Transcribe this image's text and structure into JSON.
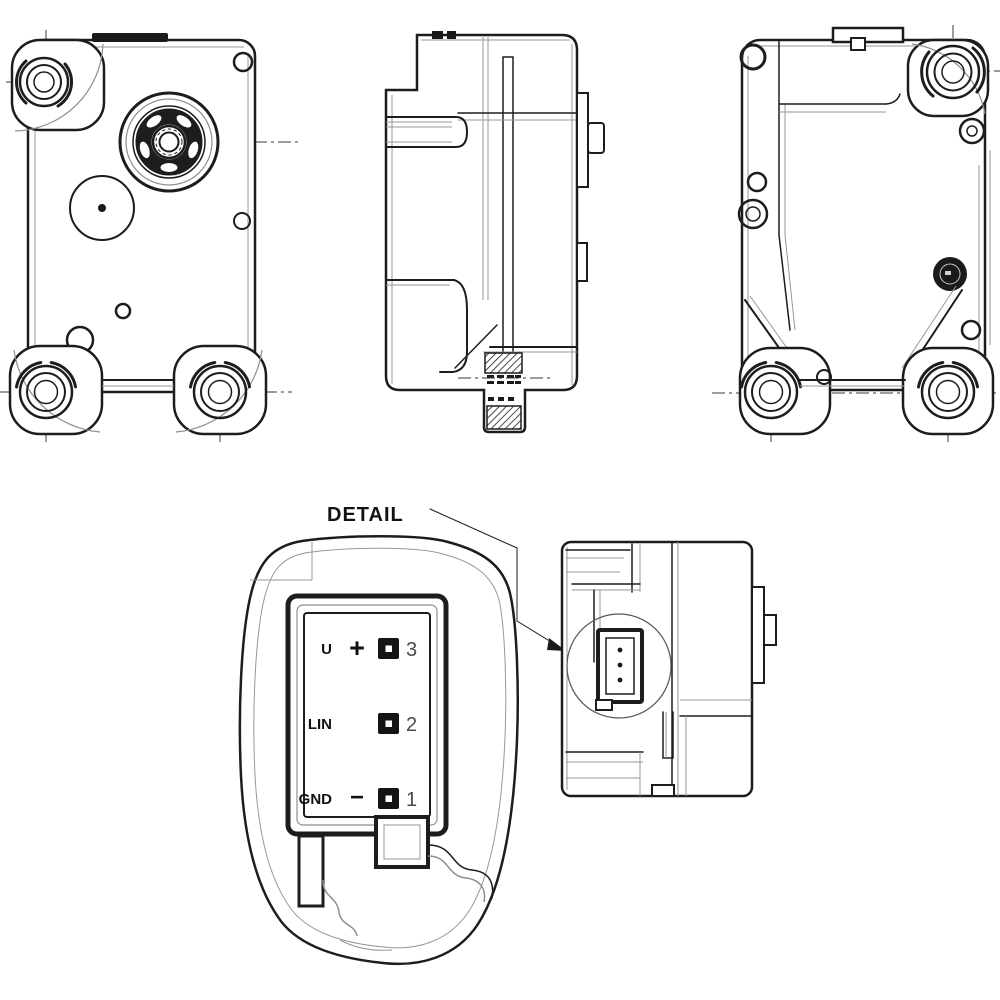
{
  "detail": {
    "label": "DETAIL"
  },
  "pins": [
    {
      "label": "U",
      "symbol": "+",
      "number": "3"
    },
    {
      "label": "LIN",
      "symbol": "",
      "number": "2"
    },
    {
      "label": "GND",
      "symbol": "−",
      "number": "1"
    }
  ],
  "colors": {
    "line": "#1d1d1b",
    "thin_line": "#979797",
    "background": "#ffffff",
    "pin_fill": "#141414"
  }
}
